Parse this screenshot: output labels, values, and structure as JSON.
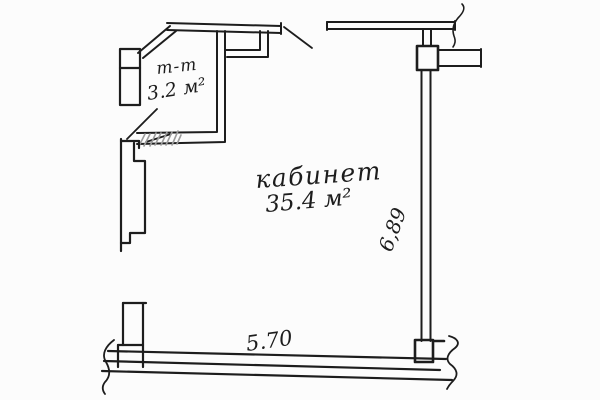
{
  "labels": {
    "small_room": {
      "section": "т-т",
      "area": "3.2 м²"
    },
    "main_room": {
      "name": "кабинет",
      "area": "35.4 м²"
    },
    "dimensions": {
      "right_wall": "6,89",
      "bottom_wall": "5.70"
    }
  },
  "colors": {
    "ink": "#1d1d1d",
    "paper": "#fcfcfc",
    "hatch": "#9b9b9b"
  }
}
